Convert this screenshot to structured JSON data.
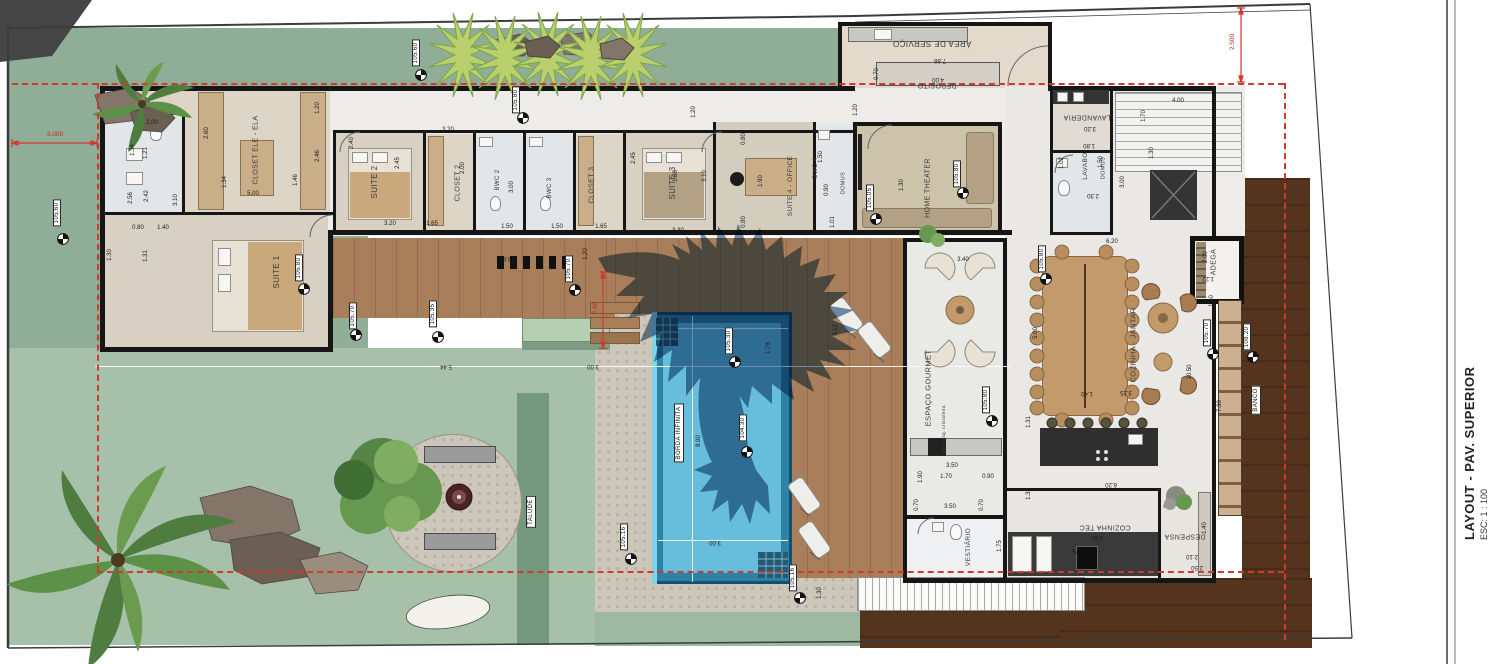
{
  "title_block": {
    "title": "LAYOUT - PAV. SUPERIOR",
    "scale": "ESC: 1 : 100"
  },
  "colors": {
    "lawn": "#8fad97",
    "lawn_light": "#a6c0aa",
    "deck_wood": "#a87f5a",
    "embankment": "#54341d",
    "pool_water": "#66bddc",
    "pool_rim": "#2e82a6",
    "pool_border": "#14506e",
    "cobblestone": "#cdc6bb",
    "wall": "#161616",
    "setback_red": "#cf3a2c",
    "eagle_shadow": "#40668a"
  },
  "rooms": [
    {
      "label": "CLOSET ELE - ELA",
      "x": 256,
      "y": 150,
      "r": "v",
      "fs": 7
    },
    {
      "label": "SUITE 1",
      "x": 277,
      "y": 272,
      "r": "v",
      "fs": 8
    },
    {
      "label": "SUITE 2",
      "x": 375,
      "y": 182,
      "r": "v",
      "fs": 8
    },
    {
      "label": "CLOSET 2",
      "x": 458,
      "y": 183,
      "r": "v",
      "fs": 7
    },
    {
      "label": "BWC 2",
      "x": 498,
      "y": 180,
      "r": "v",
      "fs": 6
    },
    {
      "label": "BWC 3",
      "x": 550,
      "y": 188,
      "r": "v",
      "fs": 6
    },
    {
      "label": "CLOSET 3",
      "x": 592,
      "y": 185,
      "r": "v",
      "fs": 7
    },
    {
      "label": "SUITE 3",
      "x": 673,
      "y": 183,
      "r": "v",
      "fs": 8
    },
    {
      "label": "SUITE 4 - OFFICE",
      "x": 791,
      "y": 186,
      "r": "v",
      "fs": 6.5
    },
    {
      "label": "BWC 4",
      "x": 816,
      "y": 168,
      "r": "v",
      "fs": 6
    },
    {
      "label": "DOMUS",
      "x": 844,
      "y": 183,
      "r": "v",
      "fs": 5.5
    },
    {
      "label": "HOME THEATER",
      "x": 928,
      "y": 188,
      "r": "v",
      "fs": 7
    },
    {
      "label": "ÁREA DE SERVIÇO",
      "x": 932,
      "y": 43,
      "r": "u",
      "fs": 8
    },
    {
      "label": "DEPOSITO",
      "x": 937,
      "y": 85,
      "r": "u",
      "fs": 7
    },
    {
      "label": "LAVANDERIA",
      "x": 1087,
      "y": 117,
      "r": "u",
      "fs": 7
    },
    {
      "label": "LAVABO",
      "x": 1086,
      "y": 166,
      "r": "v",
      "fs": 6.5
    },
    {
      "label": "DOMUS",
      "x": 1104,
      "y": 168,
      "r": "v",
      "fs": 5.5
    },
    {
      "label": "COZINHA - JANTAR",
      "x": 1133,
      "y": 345,
      "r": "v",
      "fs": 7.5
    },
    {
      "label": "ADEGA",
      "x": 1214,
      "y": 262,
      "r": "v",
      "fs": 7
    },
    {
      "label": "COZINHA TEC",
      "x": 1105,
      "y": 527,
      "r": "u",
      "fs": 7
    },
    {
      "label": "DESPENSA",
      "x": 1185,
      "y": 536,
      "r": "u",
      "fs": 7
    },
    {
      "label": "ESPAÇO GOURMET",
      "x": 928,
      "y": 388,
      "r": "v",
      "fs": 7.5
    },
    {
      "label": "VESTIÁRIO",
      "x": 969,
      "y": 547,
      "r": "v",
      "fs": 6.5
    }
  ],
  "site_labels": [
    {
      "label": "BORDA INFINITA",
      "x": 679,
      "y": 433,
      "r": "v",
      "boxed": true,
      "fs": 6
    },
    {
      "label": "TALUDE",
      "x": 531,
      "y": 512,
      "r": "v",
      "boxed": true,
      "fs": 6
    },
    {
      "label": "BANCO",
      "x": 1256,
      "y": 400,
      "r": "v",
      "boxed": true,
      "fs": 6
    },
    {
      "label": "churrasq. cristaleira",
      "x": 944,
      "y": 429,
      "r": "v",
      "boxed": false,
      "fs": 4.5
    }
  ],
  "elevations": [
    {
      "value": "105.60",
      "lx": 57,
      "ly": 213,
      "mx": 63,
      "my": 238
    },
    {
      "value": "105.60",
      "lx": 416,
      "ly": 53,
      "mx": 421,
      "my": 74
    },
    {
      "value": "105.80",
      "lx": 516,
      "ly": 100,
      "mx": 523,
      "my": 117
    },
    {
      "value": "105.80",
      "lx": 299,
      "ly": 268,
      "mx": 304,
      "my": 288
    },
    {
      "value": "105.70",
      "lx": 353,
      "ly": 316,
      "mx": 356,
      "my": 334
    },
    {
      "value": "105.35",
      "lx": 433,
      "ly": 314,
      "mx": 438,
      "my": 336
    },
    {
      "value": "105.70",
      "lx": 569,
      "ly": 269,
      "mx": 575,
      "my": 289
    },
    {
      "value": "105.30",
      "lx": 729,
      "ly": 341,
      "mx": 735,
      "my": 361
    },
    {
      "value": "104.30",
      "lx": 743,
      "ly": 428,
      "mx": 747,
      "my": 451
    },
    {
      "value": "105.16",
      "lx": 624,
      "ly": 537,
      "mx": 631,
      "my": 558
    },
    {
      "value": "105.16",
      "lx": 793,
      "ly": 578,
      "mx": 800,
      "my": 597
    },
    {
      "value": "105.05",
      "lx": 870,
      "ly": 198,
      "mx": 876,
      "my": 218
    },
    {
      "value": "105.80",
      "lx": 957,
      "ly": 174,
      "mx": 963,
      "my": 192
    },
    {
      "value": "105.80",
      "lx": 1042,
      "ly": 259,
      "mx": 1046,
      "my": 278
    },
    {
      "value": "105.80",
      "lx": 986,
      "ly": 400,
      "mx": 992,
      "my": 420
    },
    {
      "value": "105.70",
      "lx": 1207,
      "ly": 333,
      "mx": 1213,
      "my": 353
    },
    {
      "value": "108.20",
      "lx": 1247,
      "ly": 337,
      "mx": 1253,
      "my": 356
    }
  ],
  "red_dimensions": [
    {
      "value": "3.000",
      "x": 55,
      "y": 135,
      "r": "h"
    },
    {
      "value": "2.500",
      "x": 1233,
      "y": 42,
      "r": "v"
    },
    {
      "value": "2.66",
      "x": 596,
      "y": 308,
      "r": "v"
    }
  ],
  "dimensions": [
    {
      "v": "1.34",
      "x": 133,
      "y": 150,
      "r": "v"
    },
    {
      "v": "1.21",
      "x": 146,
      "y": 153,
      "r": "v"
    },
    {
      "v": "2.00",
      "x": 152,
      "y": 123,
      "r": "h"
    },
    {
      "v": "2.56",
      "x": 131,
      "y": 198,
      "r": "v"
    },
    {
      "v": "2.42",
      "x": 147,
      "y": 196,
      "r": "v"
    },
    {
      "v": "0.80",
      "x": 138,
      "y": 228,
      "r": "h"
    },
    {
      "v": "1.40",
      "x": 163,
      "y": 228,
      "r": "h"
    },
    {
      "v": "1.31",
      "x": 146,
      "y": 256,
      "r": "v"
    },
    {
      "v": "1.30",
      "x": 110,
      "y": 255,
      "r": "v"
    },
    {
      "v": "3.10",
      "x": 176,
      "y": 200,
      "r": "v"
    },
    {
      "v": "2.60",
      "x": 207,
      "y": 133,
      "r": "v"
    },
    {
      "v": "5.00",
      "x": 253,
      "y": 194,
      "r": "h"
    },
    {
      "v": "1.34",
      "x": 225,
      "y": 182,
      "r": "v"
    },
    {
      "v": "2.46",
      "x": 318,
      "y": 156,
      "r": "v"
    },
    {
      "v": "1.46",
      "x": 296,
      "y": 180,
      "r": "v"
    },
    {
      "v": "1.20",
      "x": 318,
      "y": 108,
      "r": "v"
    },
    {
      "v": "2.40",
      "x": 352,
      "y": 143,
      "r": "v"
    },
    {
      "v": "2.45",
      "x": 398,
      "y": 163,
      "r": "v"
    },
    {
      "v": "3.20",
      "x": 390,
      "y": 224,
      "r": "h"
    },
    {
      "v": "1.65",
      "x": 432,
      "y": 224,
      "r": "h"
    },
    {
      "v": "3.20",
      "x": 448,
      "y": 130,
      "r": "h"
    },
    {
      "v": "2.00",
      "x": 463,
      "y": 168,
      "r": "v"
    },
    {
      "v": "3.00",
      "x": 512,
      "y": 187,
      "r": "v"
    },
    {
      "v": "1.50",
      "x": 507,
      "y": 227,
      "r": "h"
    },
    {
      "v": "1.50",
      "x": 557,
      "y": 227,
      "r": "h"
    },
    {
      "v": "1.65",
      "x": 601,
      "y": 227,
      "r": "h"
    },
    {
      "v": "2.45",
      "x": 634,
      "y": 158,
      "r": "v"
    },
    {
      "v": "1.88",
      "x": 676,
      "y": 176,
      "r": "v"
    },
    {
      "v": "3.10",
      "x": 705,
      "y": 176,
      "r": "v"
    },
    {
      "v": "3.30",
      "x": 678,
      "y": 231,
      "r": "h"
    },
    {
      "v": "1.20",
      "x": 694,
      "y": 112,
      "r": "v"
    },
    {
      "v": "0.80",
      "x": 744,
      "y": 139,
      "r": "v"
    },
    {
      "v": "1.90",
      "x": 761,
      "y": 181,
      "r": "v"
    },
    {
      "v": "0.80",
      "x": 744,
      "y": 222,
      "r": "v"
    },
    {
      "v": "1.50",
      "x": 821,
      "y": 157,
      "r": "v"
    },
    {
      "v": "0.90",
      "x": 827,
      "y": 190,
      "r": "v"
    },
    {
      "v": "1.01",
      "x": 833,
      "y": 222,
      "r": "v"
    },
    {
      "v": "7.88",
      "x": 940,
      "y": 60,
      "r": "u"
    },
    {
      "v": "4.00",
      "x": 938,
      "y": 79,
      "r": "u"
    },
    {
      "v": "0.70",
      "x": 877,
      "y": 74,
      "r": "v"
    },
    {
      "v": "1.20",
      "x": 856,
      "y": 110,
      "r": "v"
    },
    {
      "v": "1.30",
      "x": 902,
      "y": 185,
      "r": "v"
    },
    {
      "v": "3.20",
      "x": 1090,
      "y": 128,
      "r": "u"
    },
    {
      "v": "1.70",
      "x": 1144,
      "y": 116,
      "r": "v"
    },
    {
      "v": "1.02",
      "x": 1062,
      "y": 163,
      "r": "v"
    },
    {
      "v": "1.80",
      "x": 1089,
      "y": 145,
      "r": "u"
    },
    {
      "v": "1.50",
      "x": 1101,
      "y": 162,
      "r": "v"
    },
    {
      "v": "4.00",
      "x": 1178,
      "y": 101,
      "r": "h"
    },
    {
      "v": "1.30",
      "x": 1152,
      "y": 153,
      "r": "v"
    },
    {
      "v": "3.00",
      "x": 1123,
      "y": 182,
      "r": "v"
    },
    {
      "v": "2.30",
      "x": 1093,
      "y": 195,
      "r": "u"
    },
    {
      "v": "6.20",
      "x": 1112,
      "y": 242,
      "r": "h"
    },
    {
      "v": "5.00",
      "x": 1036,
      "y": 333,
      "r": "v"
    },
    {
      "v": "1.40",
      "x": 1087,
      "y": 393,
      "r": "u"
    },
    {
      "v": "3.25",
      "x": 1126,
      "y": 392,
      "r": "u"
    },
    {
      "v": "10.50",
      "x": 1190,
      "y": 372,
      "r": "v"
    },
    {
      "v": "2.00",
      "x": 1206,
      "y": 257,
      "r": "v"
    },
    {
      "v": "1.22",
      "x": 1208,
      "y": 278,
      "r": "u"
    },
    {
      "v": "1.60",
      "x": 1212,
      "y": 301,
      "r": "v"
    },
    {
      "v": "7.98",
      "x": 1220,
      "y": 406,
      "r": "v"
    },
    {
      "v": "4.50",
      "x": 1097,
      "y": 537,
      "r": "u"
    },
    {
      "v": "2.76",
      "x": 1078,
      "y": 550,
      "r": "u"
    },
    {
      "v": "2.10",
      "x": 1192,
      "y": 556,
      "r": "u"
    },
    {
      "v": "2.50",
      "x": 1197,
      "y": 567,
      "r": "u"
    },
    {
      "v": "1.35",
      "x": 1029,
      "y": 494,
      "r": "v"
    },
    {
      "v": "6.20",
      "x": 1111,
      "y": 484,
      "r": "u"
    },
    {
      "v": "1.40",
      "x": 1205,
      "y": 528,
      "r": "v"
    },
    {
      "v": "3.40",
      "x": 963,
      "y": 260,
      "r": "h"
    },
    {
      "v": "1.31",
      "x": 1029,
      "y": 422,
      "r": "v"
    },
    {
      "v": "3.50",
      "x": 952,
      "y": 466,
      "r": "h"
    },
    {
      "v": "1.70",
      "x": 946,
      "y": 477,
      "r": "h"
    },
    {
      "v": "0.90",
      "x": 988,
      "y": 477,
      "r": "h"
    },
    {
      "v": "1.90",
      "x": 921,
      "y": 477,
      "r": "v"
    },
    {
      "v": "3.50",
      "x": 950,
      "y": 507,
      "r": "h"
    },
    {
      "v": "0.70",
      "x": 917,
      "y": 505,
      "r": "v"
    },
    {
      "v": "0.70",
      "x": 982,
      "y": 505,
      "r": "v"
    },
    {
      "v": "1.75",
      "x": 1000,
      "y": 546,
      "r": "v"
    },
    {
      "v": "8.90",
      "x": 699,
      "y": 441,
      "r": "v"
    },
    {
      "v": "3.00",
      "x": 715,
      "y": 542,
      "r": "u"
    },
    {
      "v": "1.78",
      "x": 769,
      "y": 348,
      "r": "v"
    },
    {
      "v": "3.12",
      "x": 836,
      "y": 330,
      "r": "v"
    },
    {
      "v": "1.30",
      "x": 820,
      "y": 593,
      "r": "v"
    },
    {
      "v": "5.44",
      "x": 446,
      "y": 366,
      "r": "u"
    },
    {
      "v": "3.00",
      "x": 593,
      "y": 366,
      "r": "u"
    },
    {
      "v": "12.84",
      "x": 507,
      "y": 258,
      "r": "u"
    },
    {
      "v": "1.20",
      "x": 586,
      "y": 254,
      "r": "v"
    }
  ]
}
